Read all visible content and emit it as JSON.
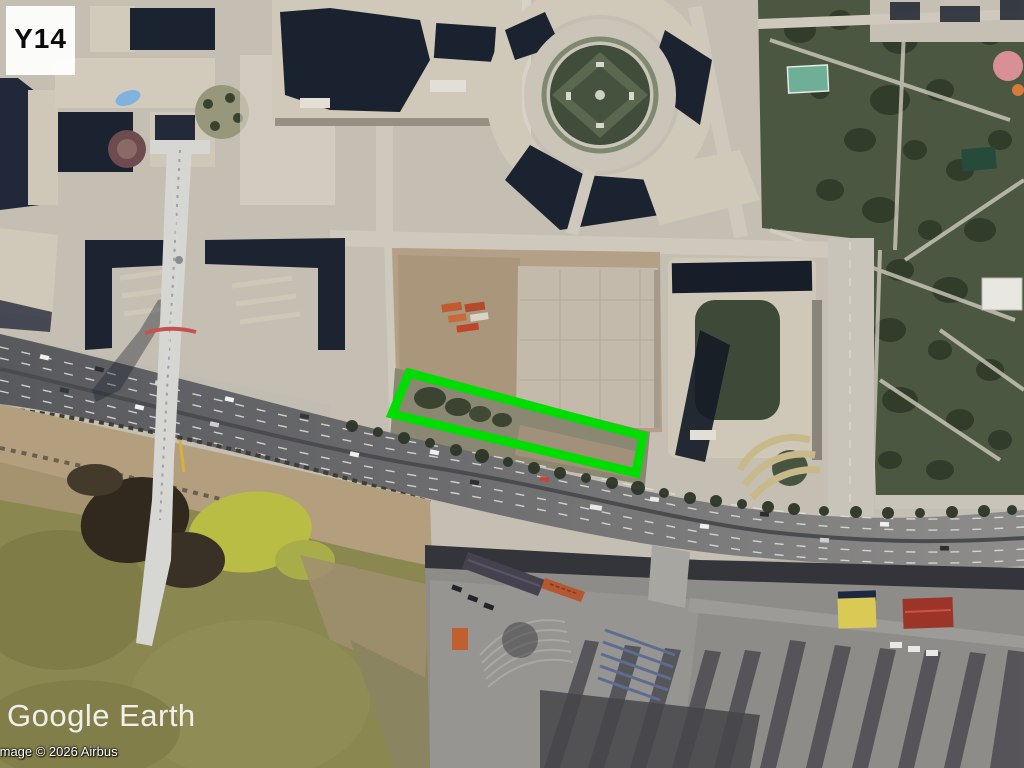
{
  "viewer": {
    "tile_label": "Y14",
    "annotation": {
      "color": "#00dd00",
      "points": "409,373 643,436 636,473 392,414"
    },
    "watermark": "Google Earth",
    "attribution": "Image © 2026 Airbus"
  }
}
